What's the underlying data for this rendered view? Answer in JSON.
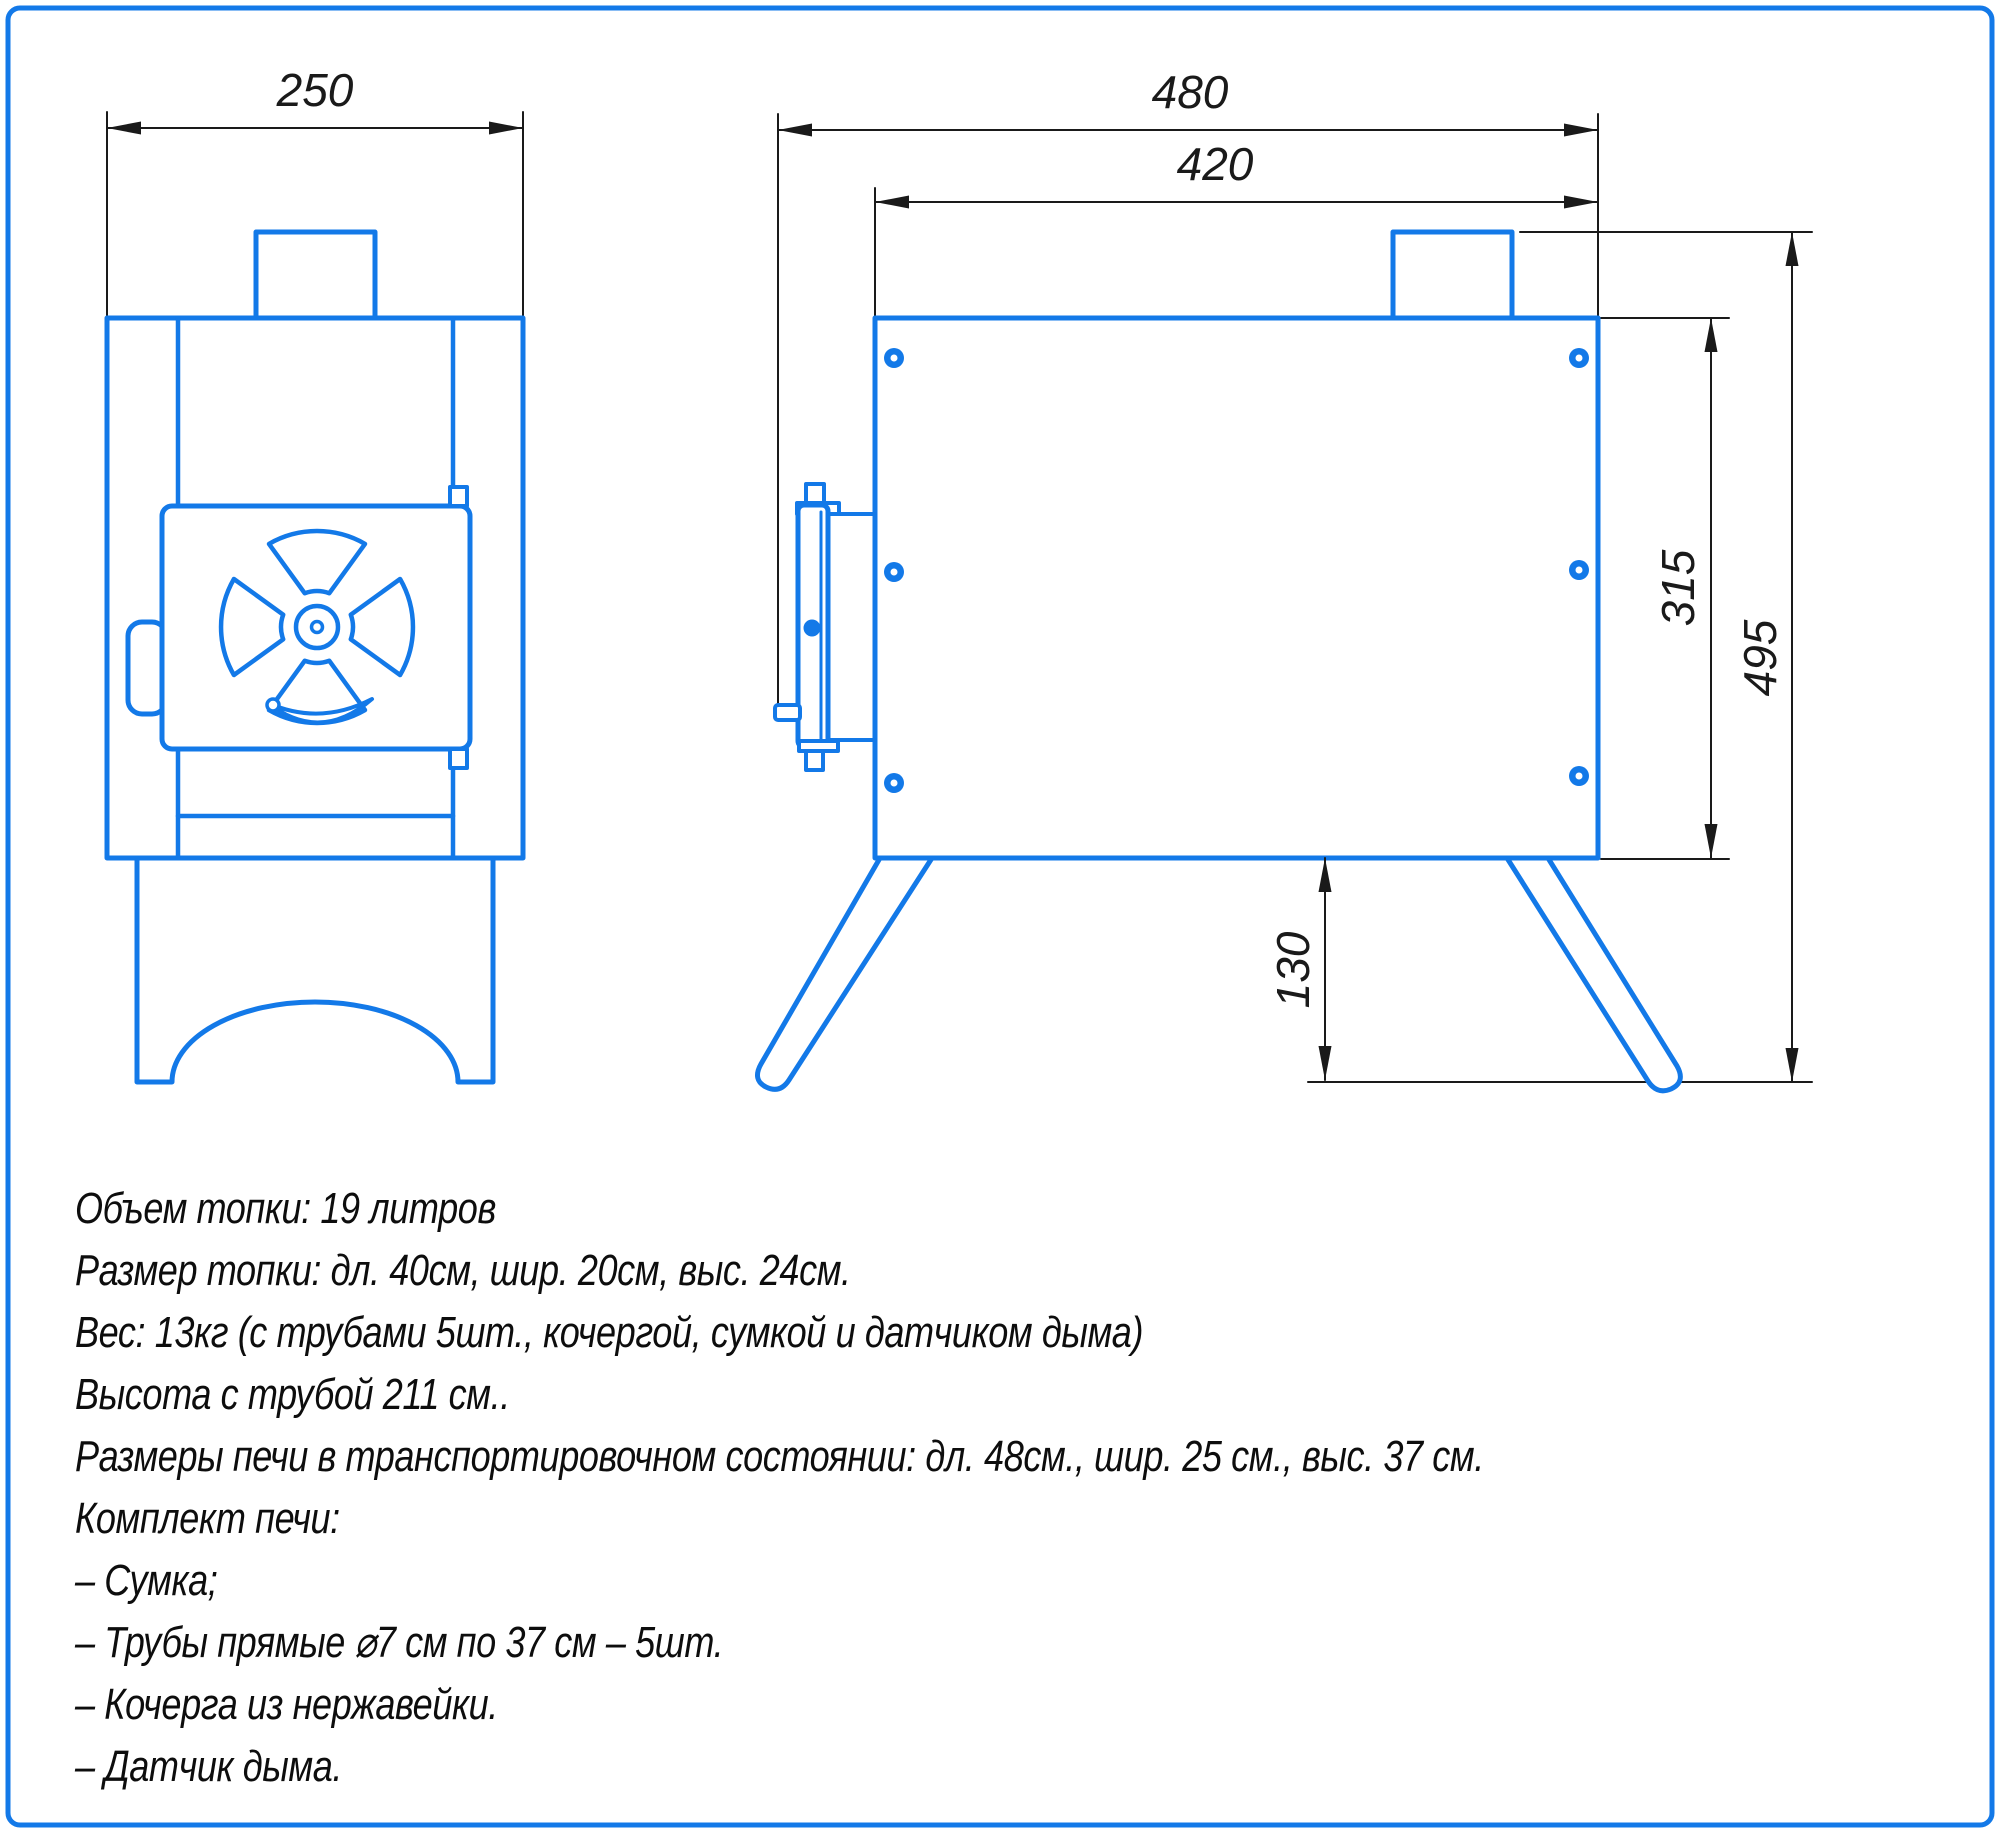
{
  "colors": {
    "line_blue": "#1379e8",
    "dim_black": "#1a1a1a"
  },
  "dimensions": {
    "front_width": "250",
    "overall_length": "480",
    "body_length": "420",
    "body_height": "315",
    "overall_height": "495",
    "leg_height": "130"
  },
  "specs": {
    "lines": [
      "Объем топки: 19 литров",
      "Размер топки: дл. 40см, шир. 20см, выс. 24см.",
      "Вес: 13кг (с трубами 5шт., кочергой, сумкой и датчиком дыма)",
      "Высота с трубой 211 см..",
      "Размеры печи в транспортировочном состоянии: дл. 48см., шир. 25 см., выс. 37 см.",
      "Комплект печи:",
      "– Сумка;",
      "– Трубы прямые ⌀7 см по 37 см – 5шт.",
      "– Кочерга из нержавейки.",
      "– Датчик дыма."
    ]
  }
}
